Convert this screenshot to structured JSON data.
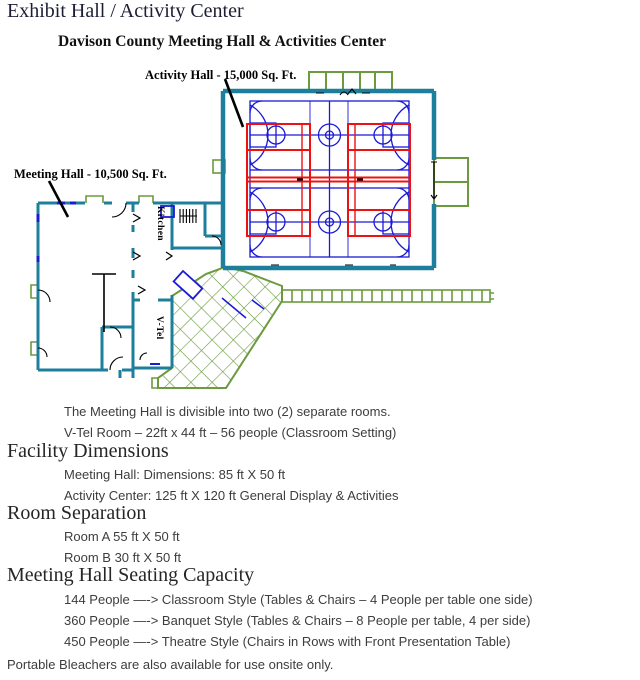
{
  "page": {
    "title": "Exhibit Hall / Activity Center",
    "subtitle": "Davison County Meeting Hall & Activities Center"
  },
  "floorplan": {
    "labels": {
      "activity_hall": "Activity Hall - 15,000 Sq. Ft.",
      "meeting_hall": "Meeting Hall - 10,500 Sq. Ft.",
      "kitchen": "Kitchen",
      "vtel": "V-Tel"
    },
    "colors": {
      "wall": "#1d7f9b",
      "court_lines": "#1b1bd6",
      "volleyball_lines": "#ee1111",
      "site_green": "#6b9a3f",
      "annotation": "#000000"
    }
  },
  "notes": [
    "The Meeting Hall is divisible into two (2) separate rooms.",
    "V-Tel Room – 22ft x 44 ft – 56 people (Classroom Setting)"
  ],
  "sections": [
    {
      "heading": "Facility Dimensions",
      "items": [
        "Meeting Hall: Dimensions: 85 ft X 50 ft",
        "Activity Center: 125 ft X 120 ft General Display & Activities"
      ]
    },
    {
      "heading": "Room Separation",
      "items": [
        "Room A 55 ft X 50 ft",
        "Room B 30 ft X 50 ft"
      ]
    },
    {
      "heading": "Meeting Hall Seating Capacity",
      "items": [
        "144 People —-> Classroom Style (Tables & Chairs – 4 People per table one side)",
        "360 People —-> Banquet Style (Tables & Chairs – 8 People per table, 4 per side)",
        "450 People —-> Theatre Style (Chairs in Rows with Front Presentation Table)"
      ]
    }
  ],
  "footer_note": "Portable Bleachers are also available for use onsite only."
}
